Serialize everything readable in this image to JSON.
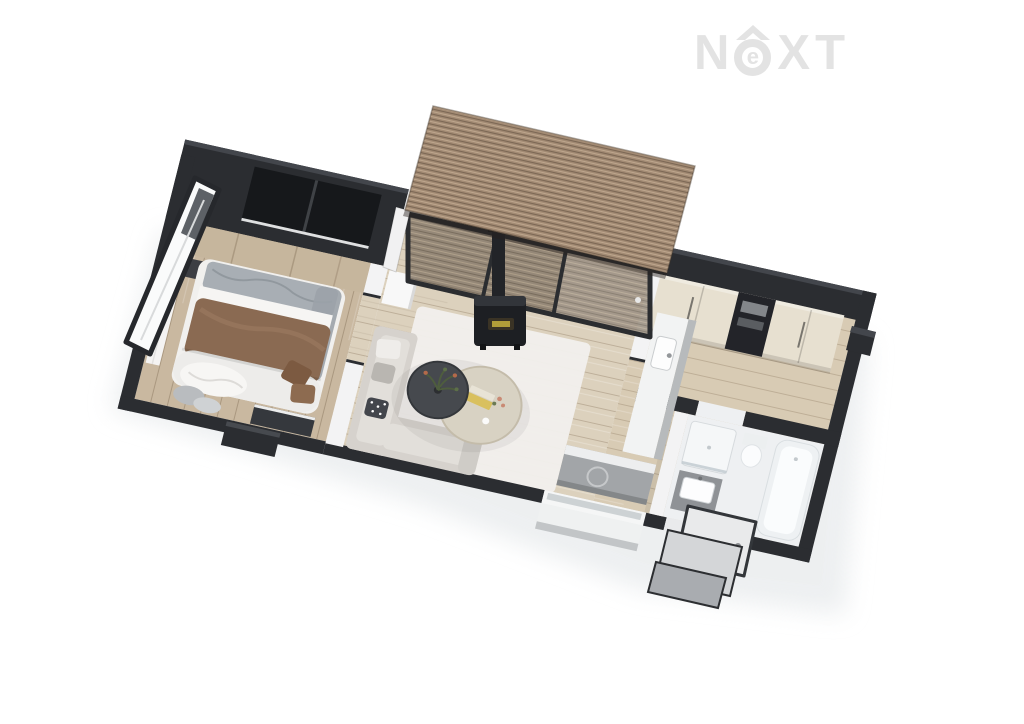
{
  "logo": {
    "text": "NEXT",
    "n": "N",
    "e": "e",
    "x": "X",
    "t": "T"
  },
  "palette": {
    "bg": "#ffffff",
    "shadow": "#e7eaec",
    "wall": "#2b2d31",
    "wallTopLight": "#43464c",
    "partition": "#f3f3f4",
    "windowGlassDark": "#16181b",
    "woodBedroom": "#c9b8a0",
    "woodLiving": "#dcd1bd",
    "woodHall": "#d8cbb4",
    "bathFloor": "#eef0f2",
    "roofBase": "#a38b74",
    "roofStripeDark": "#7b6754",
    "roofStripeLight": "#c7b097",
    "glassTint": "#8d8070",
    "cabinetCream": "#e7e0d0",
    "applianceDark": "#232429",
    "counterTop": "#f2f3f3",
    "counterFront": "#b7babc",
    "lowboardGray": "#a2a5a8",
    "sofa": "#d6d2cd",
    "sofaCushion": "#e2dfda",
    "rug": "#f1efec",
    "duvetBrown": "#8a6a52",
    "pillowGray": "#a8aeb4",
    "bedWhite": "#f1f0ee",
    "tableDark": "#46494e",
    "tableCream": "#d8d2c3",
    "stoveBlack": "#1d1f23",
    "stoveGlow": "#c0aa3c",
    "vanityGray": "#8f9296",
    "stepGray": "#d4d6d8",
    "logoGray": "#e3e3e3"
  },
  "scene": {
    "type": "3d-floor-plan-render",
    "rooms": [
      {
        "name": "bedroom",
        "items": [
          "double-bed",
          "wood-headboard-wall",
          "window",
          "open-glass-door",
          "curtain",
          "nightstand",
          "console",
          "exterior-step"
        ]
      },
      {
        "name": "living-room",
        "items": [
          "corner-sofa",
          "round-table-dark",
          "round-table-cream",
          "area-rug",
          "wood-stove",
          "chimney-pipe",
          "glass-wall",
          "terrace-slat-roof",
          "window-ledge",
          "wardrobe"
        ]
      },
      {
        "name": "kitchen-hall",
        "items": [
          "tall-cabinets",
          "built-in-appliance-column",
          "counter-with-sink",
          "lowboard"
        ]
      },
      {
        "name": "bathroom",
        "items": [
          "bathtub",
          "shower",
          "toilet",
          "vanity-sink"
        ]
      },
      {
        "name": "entrance",
        "items": [
          "open-door",
          "steps"
        ]
      }
    ]
  }
}
